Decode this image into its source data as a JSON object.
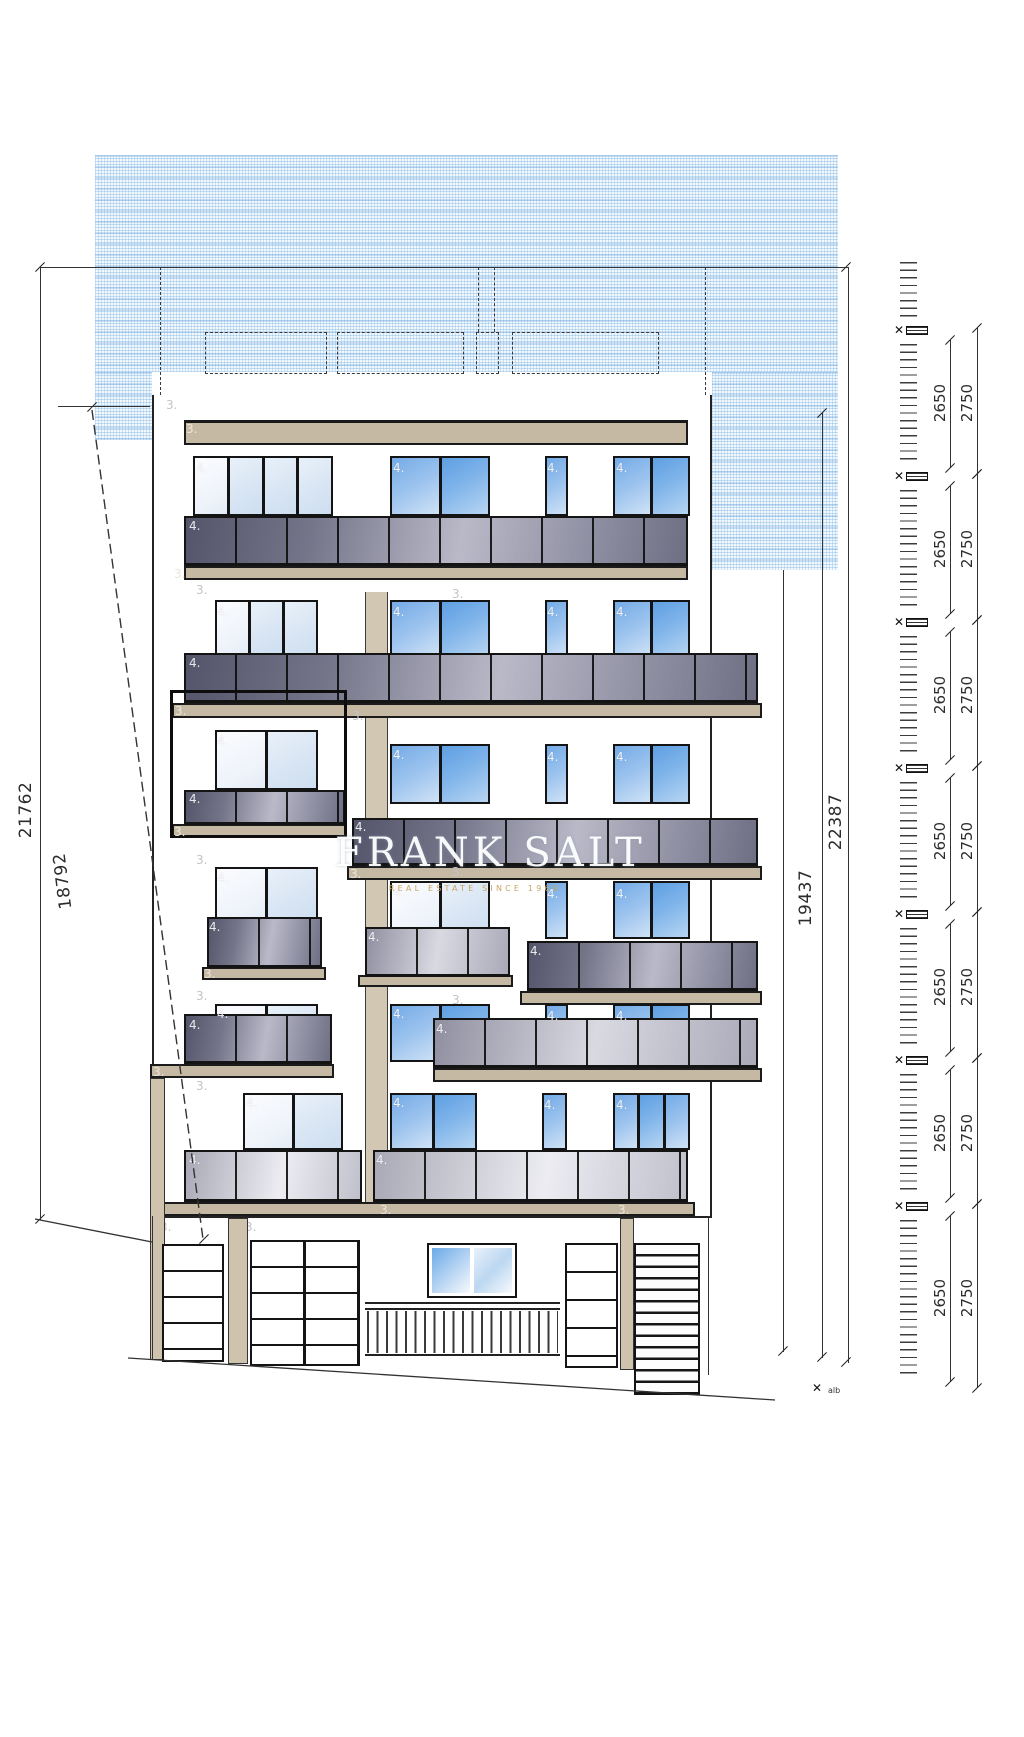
{
  "meta": {
    "drawing_type": "building front elevation"
  },
  "markers": {
    "unit1": "1.",
    "unit2": "2.",
    "unit3": "3.",
    "unit4": "4."
  },
  "dimensions": {
    "left_total": "21762",
    "left_boundary": "18792",
    "right_total": "22387",
    "right_facade": "19437"
  },
  "ladder": {
    "levels": [
      {
        "clear": "2650",
        "pitch": "2750"
      },
      {
        "clear": "2650",
        "pitch": "2750"
      },
      {
        "clear": "2650",
        "pitch": "2750"
      },
      {
        "clear": "2650",
        "pitch": "2750"
      },
      {
        "clear": "2650",
        "pitch": "2750"
      },
      {
        "clear": "2650",
        "pitch": "2750"
      },
      {
        "clear": "2650",
        "pitch": "2750"
      }
    ],
    "bottom_note": "alb"
  },
  "watermark": {
    "title": "FRANK SALT",
    "subtitle": "REAL ESTATE SINCE 1969"
  }
}
